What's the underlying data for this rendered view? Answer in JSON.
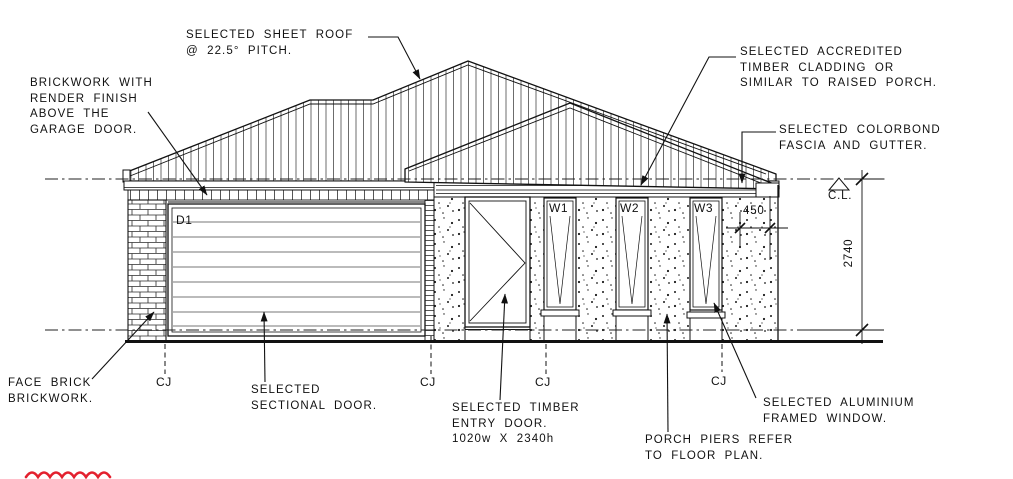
{
  "drawing": {
    "title": "house front elevation working drawing",
    "colors": {
      "line": "#111111",
      "markup_red": "#e3202e",
      "paper": "#ffffff"
    },
    "labels": {
      "sheet_roof": "SELECTED SHEET ROOF\n@ 22.5° PITCH.",
      "brick_render": "BRICKWORK WITH\nRENDER FINISH\nABOVE THE\nGARAGE DOOR.",
      "timber_cladding": "SELECTED ACCREDITED\nTIMBER CLADDING OR\nSIMILAR TO RAISED PORCH.",
      "colorbond": "SELECTED COLORBOND\nFASCIA AND GUTTER.",
      "face_brick": "FACE BRICK\nBRICKWORK.",
      "sectional_door": "SELECTED\nSECTIONAL DOOR.",
      "entry_door": "SELECTED TIMBER\nENTRY DOOR.\n1020w X 2340h",
      "porch_piers": "PORCH PIERS REFER\nTO FLOOR PLAN.",
      "aluminium_window": "SELECTED ALUMINIUM\nFRAMED WINDOW."
    },
    "tags": {
      "garage_door": "D1",
      "window_1": "W1",
      "window_2": "W2",
      "window_3": "W3"
    },
    "dims": {
      "wall_height": "2740",
      "pier_width": "450",
      "ceiling_level": "C.L."
    },
    "joints": {
      "label": "CJ"
    }
  }
}
